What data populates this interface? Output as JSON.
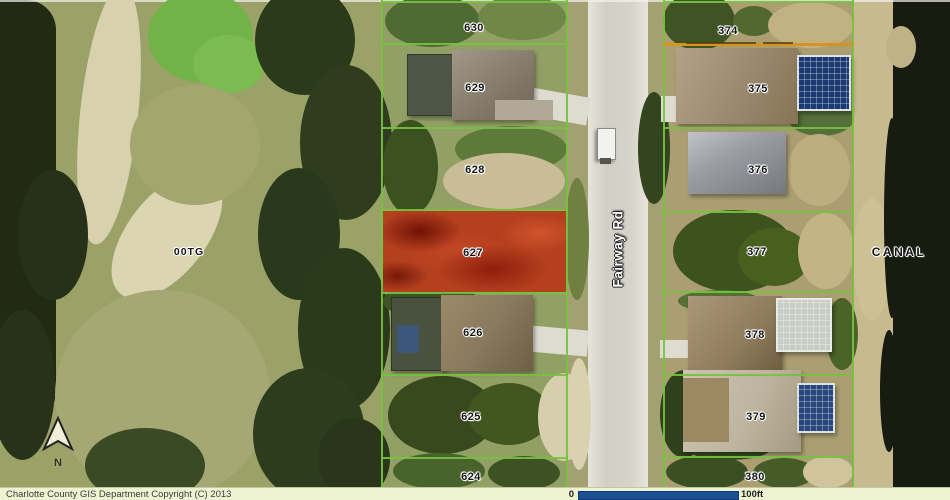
{
  "title": "Charlotte County GIS parcel map",
  "colors": {
    "parcel_line_green": "#74c23e",
    "highlight_red": "#b5401f",
    "orange_line": "#d8931f",
    "scale_bar_blue": "#1d4f94",
    "status_bar_bg": "#eef3d2"
  },
  "parcels": {
    "left": [
      "630",
      "629",
      "628",
      "627",
      "626",
      "625",
      "624"
    ],
    "right": [
      "374",
      "375",
      "376",
      "377",
      "378",
      "379",
      "380"
    ],
    "highlighted": "627"
  },
  "labels": {
    "road": "Fairway Rd",
    "area_left": "00TG",
    "canal": "CANAL",
    "north": "N"
  },
  "status_bar": {
    "copyright": "Charlotte County GIS Department Copyright (C) 2013",
    "scale_start": "0",
    "scale_end": "100ft"
  }
}
